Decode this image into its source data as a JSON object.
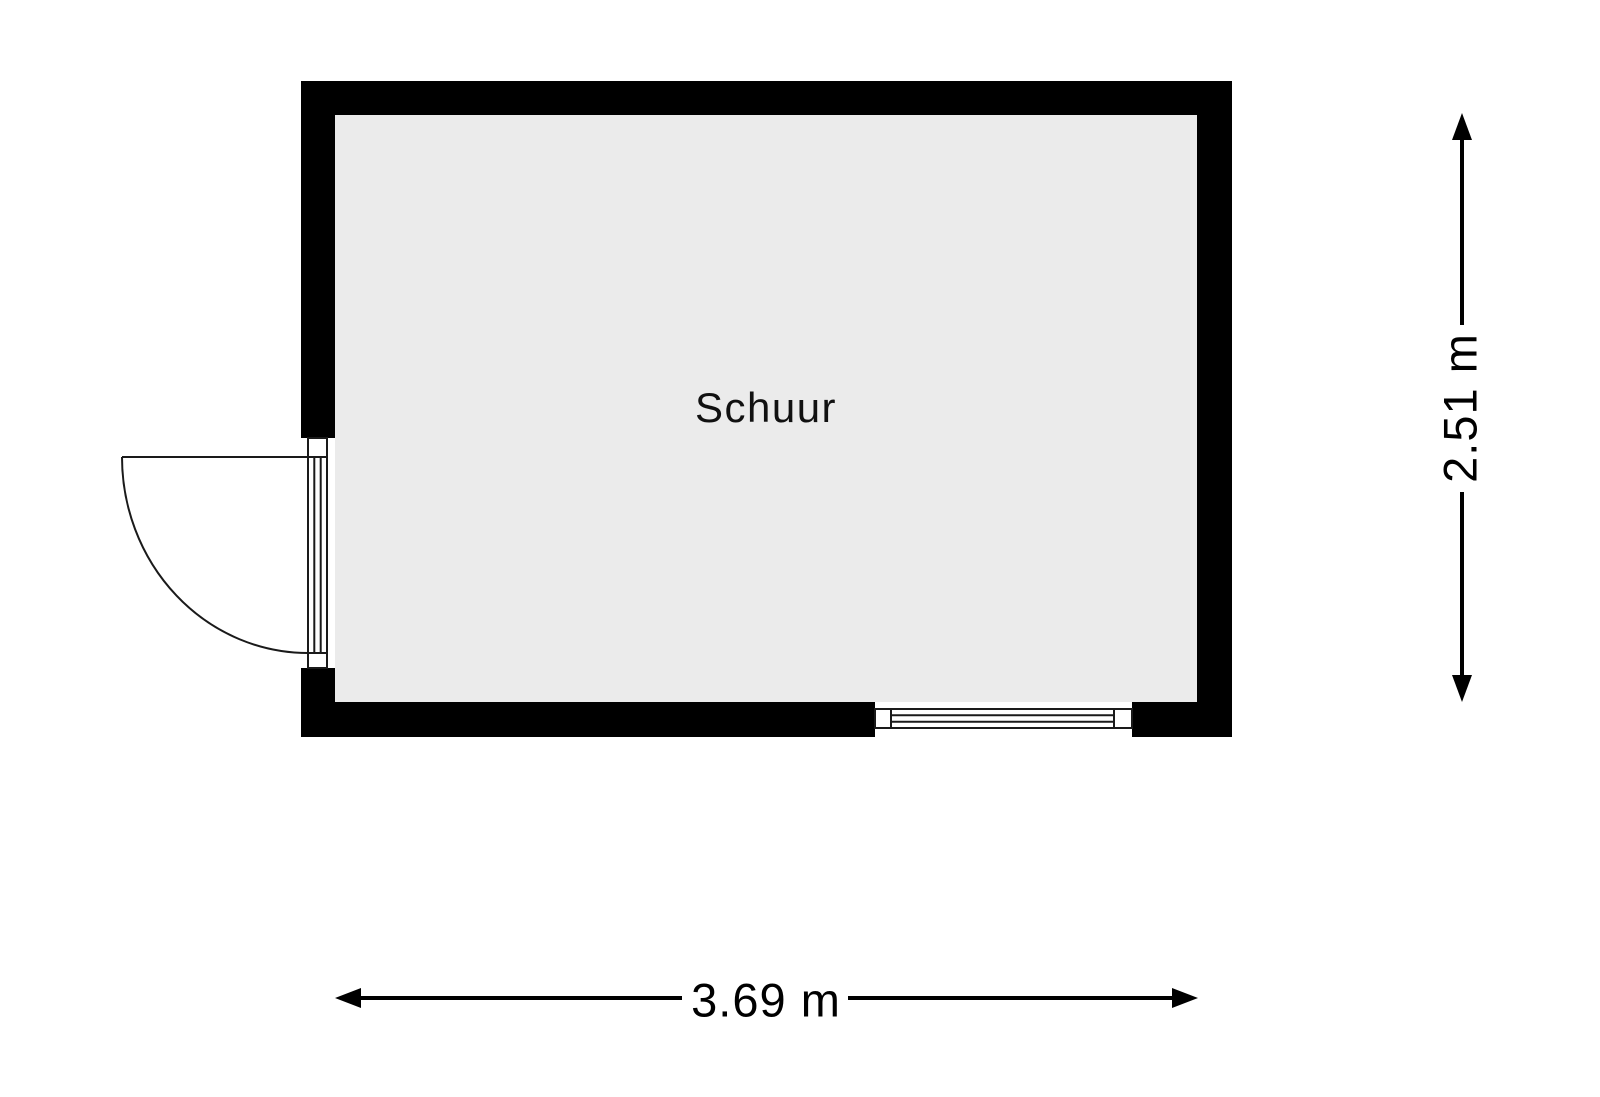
{
  "floorplan": {
    "room": {
      "label": "Schuur"
    },
    "dimensions": {
      "width": {
        "label": "3.69 m",
        "meters": 3.69
      },
      "height": {
        "label": "2.51 m",
        "meters": 2.51
      }
    },
    "features": {
      "door": "door-left-wall-swing-outward",
      "window": "window-bottom-wall"
    },
    "colors": {
      "wall": "#000000",
      "floor": "#ebebeb",
      "linework": "#1a1a1a",
      "background": "#ffffff"
    }
  }
}
